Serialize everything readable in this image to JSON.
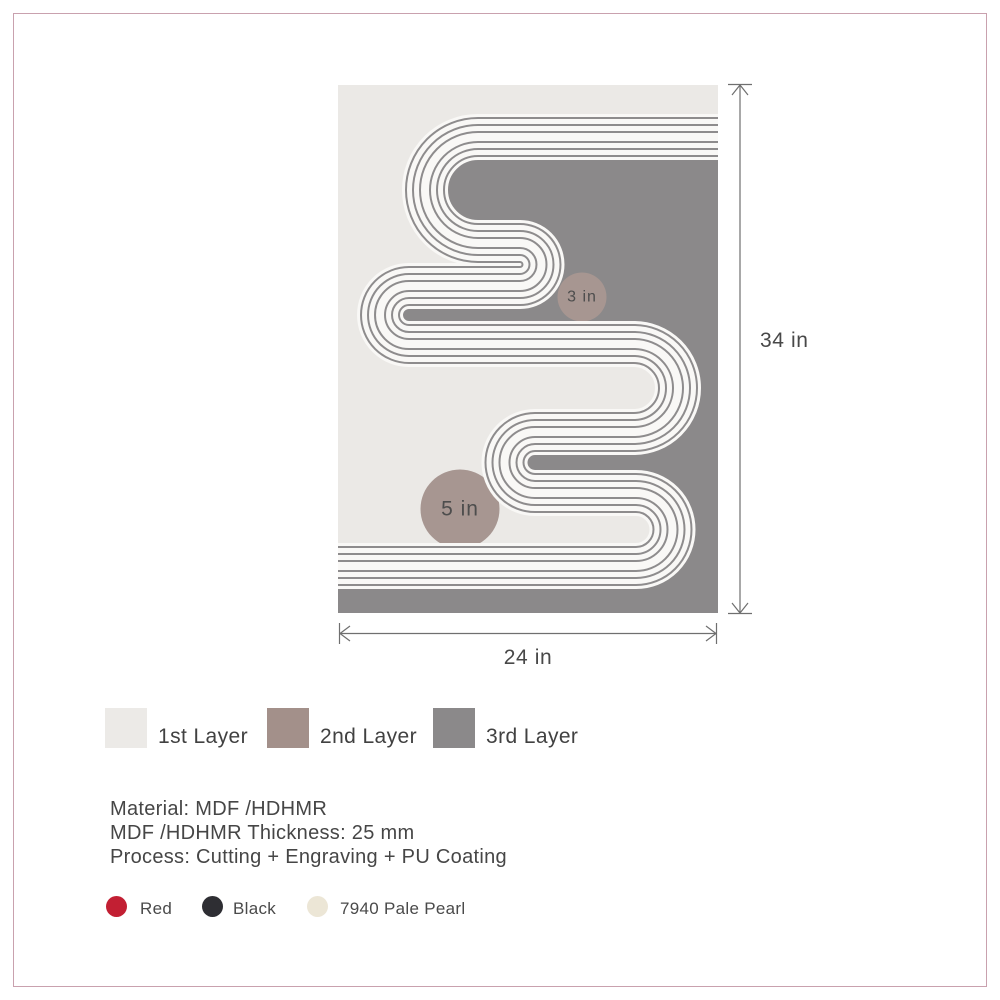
{
  "artwork": {
    "small_circle_label": "3 in",
    "large_circle_label": "5 in",
    "colors": {
      "layer1_bg": "#EBE9E6",
      "layer2_accent": "#A79691",
      "layer3_bg": "#8B898A",
      "stripe_white": "#F9F8F6",
      "stripe_line": "#8E8C8D",
      "annotation_text": "#4D4D4D"
    }
  },
  "dimensions": {
    "height_label": "34 in",
    "width_label": "24 in"
  },
  "legend": {
    "items": [
      {
        "label": "1st Layer",
        "color": "#ECEAE7"
      },
      {
        "label": "2nd Layer",
        "color": "#A3908A"
      },
      {
        "label": "3rd Layer",
        "color": "#8B898A"
      }
    ]
  },
  "specs": {
    "line1": "Material: MDF /HDHMR",
    "line2": "MDF /HDHMR Thickness: 25 mm",
    "line3": "Process: Cutting + Engraving + PU Coating"
  },
  "finishes": {
    "items": [
      {
        "label": "Red",
        "color": "#C21F33"
      },
      {
        "label": "Black",
        "color": "#2E2E33"
      },
      {
        "label": "7940 Pale Pearl",
        "color": "#ECE6D6"
      }
    ]
  },
  "frame": {
    "border_color": "#C9A1AE"
  }
}
